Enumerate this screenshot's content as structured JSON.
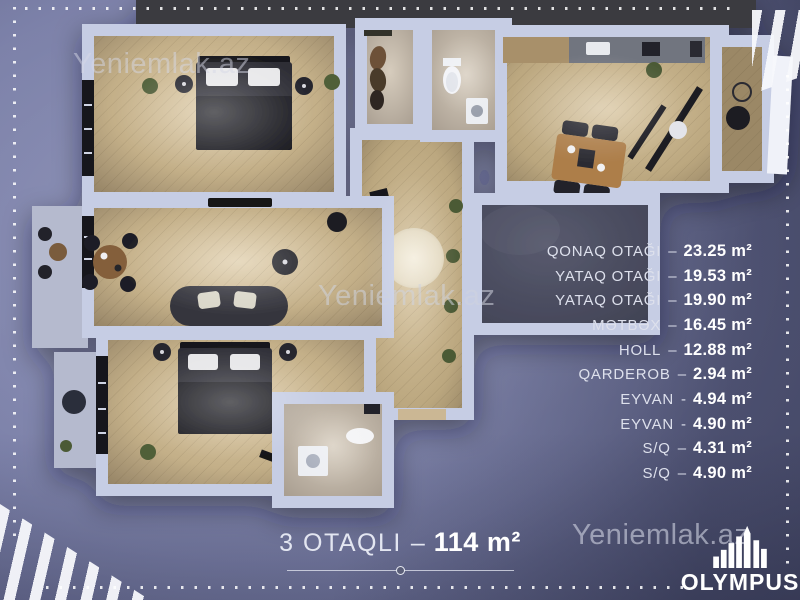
{
  "watermarks": {
    "top_left": "Yeniemlak.az",
    "center": "Yeniemlak.az",
    "bottom_right": "Yeniemlak.az"
  },
  "room_list": {
    "rooms": [
      {
        "name": "QONAQ OTAĞI",
        "sep": "–",
        "area": "23.25 m²"
      },
      {
        "name": "YATAQ OTAĞI",
        "sep": "–",
        "area": "19.53 m²"
      },
      {
        "name": "YATAQ OTAĞI",
        "sep": "–",
        "area": "19.90 m²"
      },
      {
        "name": "MƏTBƏX",
        "sep": "–",
        "area": "16.45 m²"
      },
      {
        "name": "HOLL",
        "sep": "–",
        "area": "12.88 m²"
      },
      {
        "name": "QARDEROB",
        "sep": "–",
        "area": "2.94 m²"
      },
      {
        "name": "EYVAN",
        "sep": "-",
        "area": "4.94 m²"
      },
      {
        "name": "EYVAN",
        "sep": "-",
        "area": "4.90 m²"
      },
      {
        "name": "S/Q",
        "sep": "–",
        "area": "4.31 m²"
      },
      {
        "name": "S/Q",
        "sep": "–",
        "area": "4.90 m²"
      }
    ]
  },
  "footer": {
    "apartment_type": "3 OTAQLI",
    "sep": "–",
    "total_area": "114 m²"
  },
  "brand": {
    "name": "OLYMPUS",
    "icon": "building-bars"
  },
  "colors": {
    "background_center": "#888db5",
    "background_edge": "#494d68",
    "wall": "#c6cde4",
    "wood_floor": "#c2ae87",
    "text_label": "#dde0ec",
    "text_value": "#ffffff",
    "brand_white": "#ffffff"
  }
}
